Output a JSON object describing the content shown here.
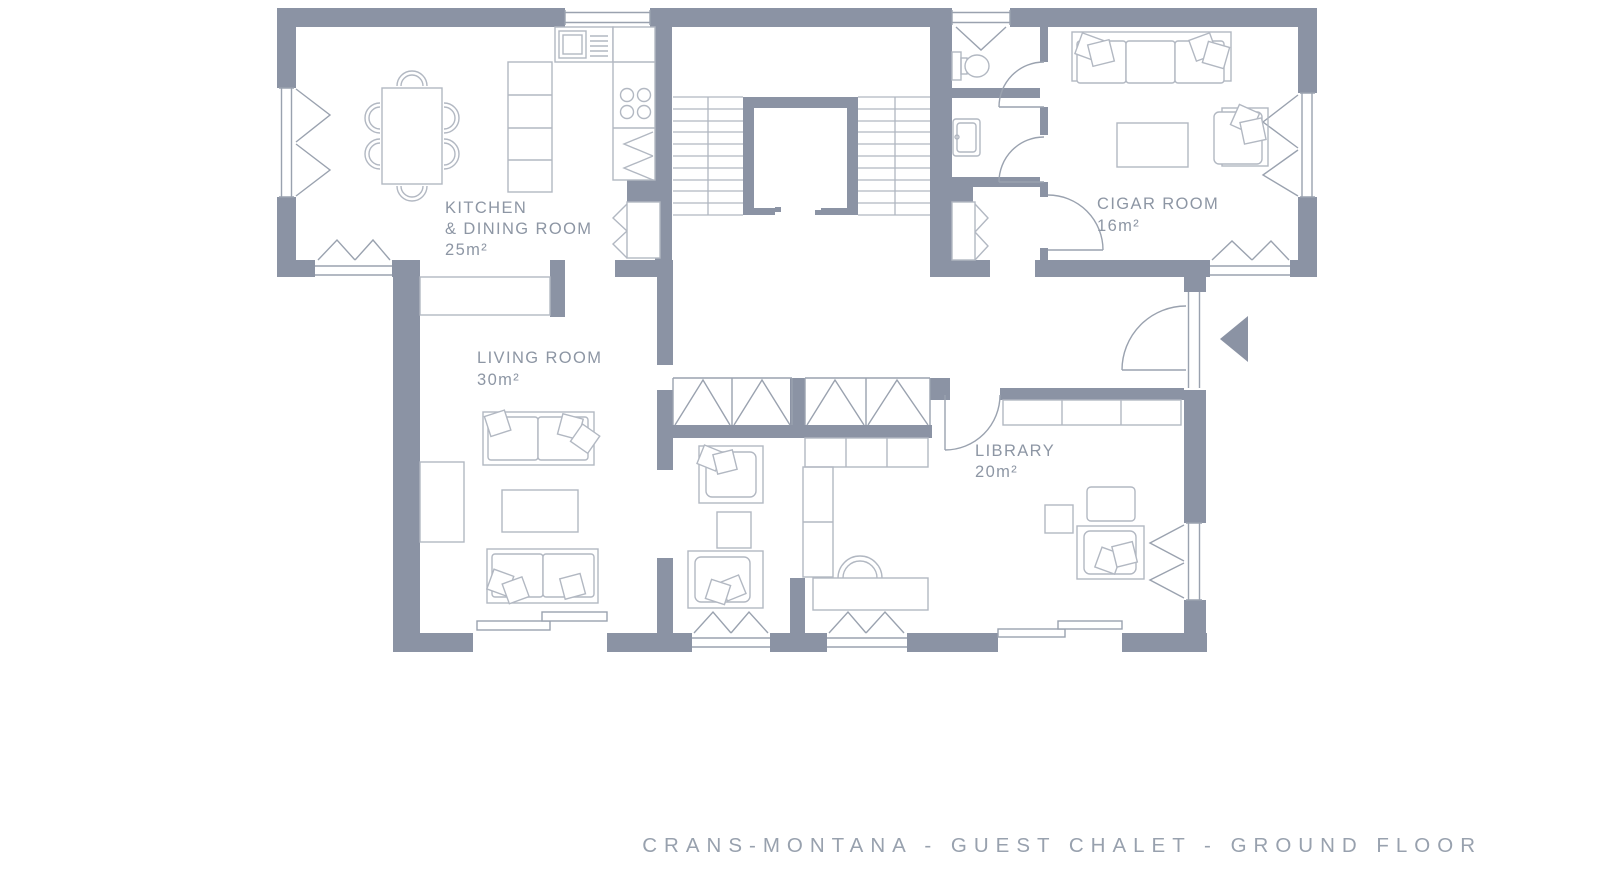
{
  "plan": {
    "caption": "CRANS-MONTANA - GUEST CHALET - GROUND FLOOR",
    "rooms": {
      "kitchen": {
        "label_line1": "KITCHEN",
        "label_line2": "& DINING ROOM",
        "area": "25m²"
      },
      "cigar": {
        "label": "CIGAR ROOM",
        "area": "16m²"
      },
      "living": {
        "label": "LIVING ROOM",
        "area": "30m²"
      },
      "library": {
        "label": "LIBRARY",
        "area": "20m²"
      }
    },
    "colors": {
      "wall": "#8b93a4",
      "fixture_line": "#9aa2af",
      "furniture_line": "#b2b8c2",
      "label_text": "#8d96a4",
      "caption_text": "#98a1ae"
    }
  }
}
